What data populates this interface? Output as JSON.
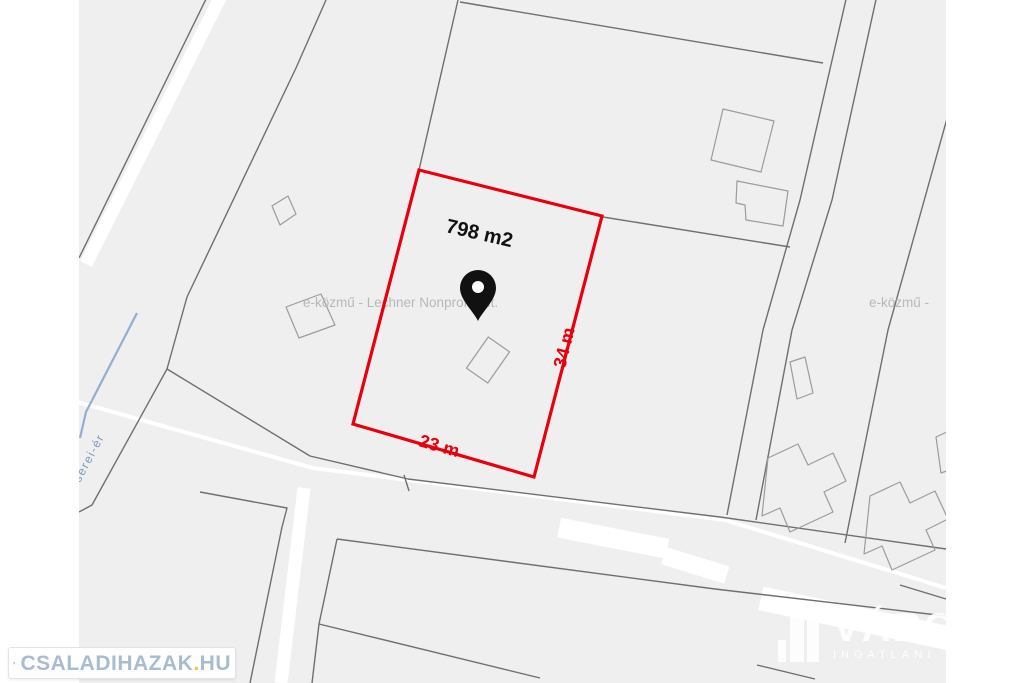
{
  "map": {
    "background_color": "#efeff0",
    "boundary_line_color": "#6f6f6f",
    "building_outline_color": "#9c9c9c",
    "creek_color": "#93aed1",
    "creek_label": "serei-ér",
    "watermark_center": "e-közmű - Lechner Nonprofit Kft.",
    "watermark_right": "e-közmű - ",
    "watermark_color": "#b8b8b8"
  },
  "parcel": {
    "area_label": "798 m2",
    "side_right_label": "34 m",
    "side_bottom_label": "23 m",
    "outline_color": "#e8000d",
    "area_label_color": "#111111",
    "pin_color": "#111111"
  },
  "branding": {
    "logo_text_main": "CSALADIHAZAK",
    "logo_text_dot": ".",
    "logo_text_tld": "HU",
    "logo_text_color": "#a9bccf",
    "logo_dot_color": "#ecc545",
    "watermark_title": "VÁRO",
    "watermark_subtitle": "INGATLANI",
    "watermark_color": "#ffffff"
  }
}
